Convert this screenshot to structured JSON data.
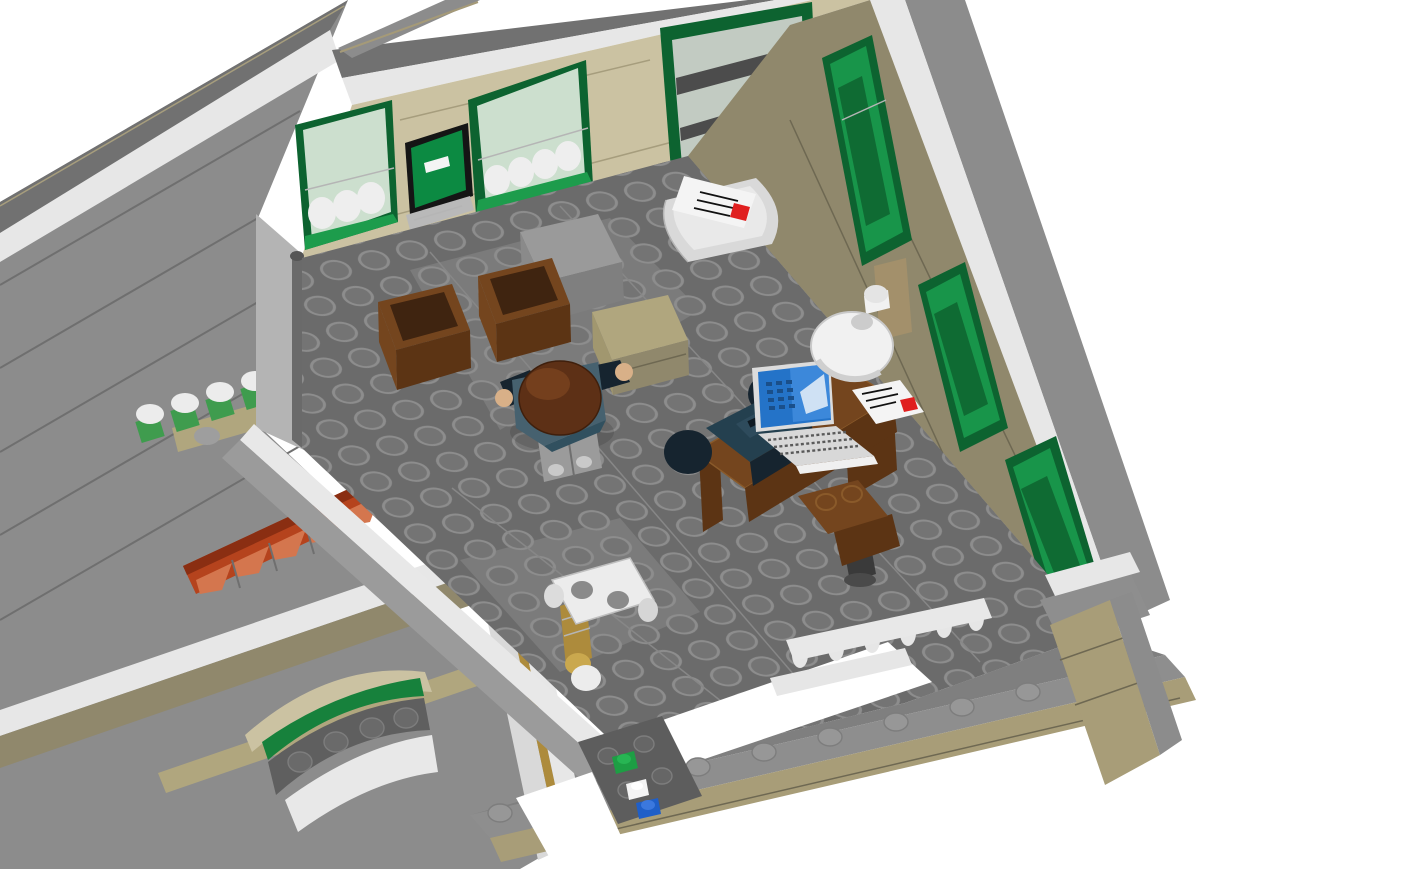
{
  "scene": {
    "app": "lego-3d-render",
    "description": "Top-down angled view into a LEGO modular post-office interior room; white background; gray outer walls, tan interior walls with green windows, dark gray studded floor; minifigure at work area with desk, laptop, typewriter and lamp; mail counter with envelopes; postal scale; balustrade beside a floor opening; exterior left wall with flower boxes, red awnings and arched entrance with green sign.",
    "visible_text": ""
  },
  "colors": {
    "bg": "#ffffff",
    "slab": "#8c8c8c",
    "slab_dark": "#7f7f7f",
    "roof_dark": "#717171",
    "trim_white": "#e7e7e7",
    "edge_tan": "#a59a78",
    "wall_tan": "#cbc2a2",
    "wall_tan_dark": "#90886c",
    "baseboard": "#575757",
    "floor": "#6b6b6b",
    "floor_light": "#7b7b7b",
    "floor_plate_dark": "#5d5d5d",
    "stud_fill": "#747474",
    "stud_stroke": "#8d8d8d",
    "cap_stud": "#979797",
    "interior_strip": "#b4b4b4",
    "pole_gray": "#6a6a6a",
    "ridge_white": "#e8e8e8",
    "ridge_gray": "#9b9b9b",
    "green_frame": "#0d6330",
    "green_mid": "#18954a",
    "green_bright": "#1d9c4c",
    "green_sign": "#17813c",
    "glass_light": "#ccdfce",
    "glass_gray": "#c2cbc2",
    "curtain": "#eeeeee",
    "shelf_dark": "#4c4c4c",
    "atm_black": "#151515",
    "atm_green": "#0c8a42",
    "white_piece": "#f4f4f4",
    "red_stamp": "#e01f1f",
    "awning_red": "#b5431d",
    "awning_red_dark": "#8a2e12",
    "awning_red_light": "#d4764e",
    "flower_white": "#ececec",
    "flower_green": "#3f9c4e",
    "ledge_tan": "#b0a67e",
    "bowl_gray": "#9e9e9e",
    "brown": "#74451e",
    "brown_dark": "#5c3414",
    "brown_darker": "#3f2410",
    "brown_light": "#8a5a2a",
    "navy": "#24404f",
    "navy_dark": "#16242f",
    "navy_mid": "#2e4b5c",
    "hair_brown": "#5d3016",
    "hair_light": "#7a431f",
    "skin_tan": "#d8b088",
    "legs_gray": "#9b9b9b",
    "boot_silver": "#c9c9c9",
    "laptop_frame": "#dcdcdc",
    "laptop_blue": "#2473c8",
    "laptop_blue_light": "#4a93e4",
    "laptop_dark_px": "#1a4f8a",
    "key_gray": "#d8d8d8",
    "lamp_white": "#f1f1f1",
    "lamp_shade": "#d8d8d8",
    "brass": "#ad8b3c",
    "brass_light": "#caa84e",
    "blue_piece": "#1f5fc8",
    "green_piece": "#1d9e44",
    "gray_box": "#9a9a9a",
    "gray_box_side": "#7f7f7f",
    "cap_gray": "#8e8e8e",
    "front_tan": "#a89d78",
    "counter_white": "#d9d9d9",
    "counter_top": "#e9e9e9",
    "baluster_white": "#e6e6e6",
    "scale_white": "#ececec",
    "shadow": "#000000"
  },
  "objects": {
    "minifigure": {
      "label": "minifigure seen from above",
      "hair": "#5d3016",
      "torso": "#46616f",
      "legs": "#9b9b9b"
    },
    "desk": {
      "label": "brown office desk",
      "items": [
        "navy typewriter",
        "laptop with blue screen",
        "white envelope with red stamp",
        "white desk lamp"
      ]
    },
    "office_chair": {
      "label": "brown swivel chair"
    },
    "crates": {
      "label": "two brown open crates",
      "count": 2
    },
    "gray_box": {
      "label": "light gray box"
    },
    "package_box": {
      "label": "tan parcel box"
    },
    "mail_counter": {
      "label": "white rounded counter with envelope",
      "envelope_stamp": "#e01f1f"
    },
    "postal_scale": {
      "label": "white and brass postal scale"
    },
    "balustrade": {
      "label": "white balustrade railing",
      "balusters": 6
    },
    "floor_opening": {
      "label": "stairwell opening in floor"
    },
    "back_windows": {
      "label": "green framed shop windows with white curtains",
      "count": 2
    },
    "atm_panel": {
      "label": "green wall panel with white letter slot"
    },
    "display_window": {
      "label": "large green display window with dark shelves"
    },
    "right_windows": {
      "label": "green windows along right wall",
      "count": 3
    },
    "flower_boxes": {
      "label": "white flowers in green window boxes",
      "count": 6
    },
    "brown_awnings": {
      "label": "round reddish-brown awnings",
      "count": 2
    },
    "red_awning_row": {
      "label": "red striped awning strip",
      "segments": 6
    },
    "arched_entrance": {
      "label": "arched entrance with green sign and white awning"
    },
    "loose_bricks": {
      "label": "loose 1x1 bricks on floor",
      "colors": [
        "green",
        "white",
        "blue"
      ]
    }
  }
}
